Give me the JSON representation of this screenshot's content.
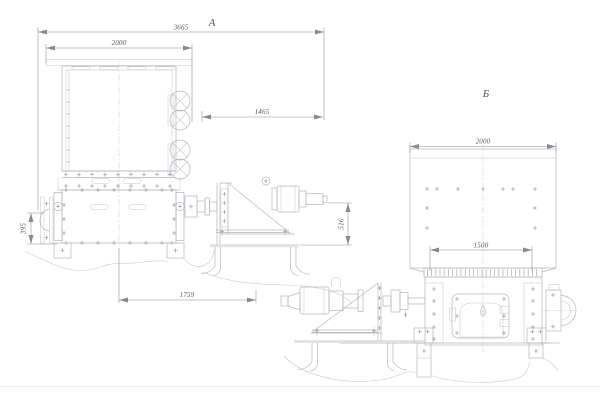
{
  "drawing": {
    "type": "engineering-drawing",
    "views": [
      {
        "id": "a",
        "label": "А"
      },
      {
        "id": "b",
        "label": "Б"
      }
    ]
  },
  "annotations": {
    "view_a_label": "А",
    "view_b_label": "Б",
    "dim_overall": "3665",
    "dim_hopper_a": "2000",
    "dim_drive": "1465",
    "dim_left_height": "395",
    "dim_motor_height": "516",
    "dim_base": "1759",
    "dim_hopper_b": "2000",
    "dim_flange_b": "1500"
  },
  "palette": {
    "bg": "#ffffff",
    "line": "#b2b6bd",
    "line2": "#c3c6cc",
    "dim": "#878b93",
    "bolt": "#868a92",
    "center": "#c6c9cf",
    "text": "#53575e",
    "separator": "#ebedf0"
  }
}
